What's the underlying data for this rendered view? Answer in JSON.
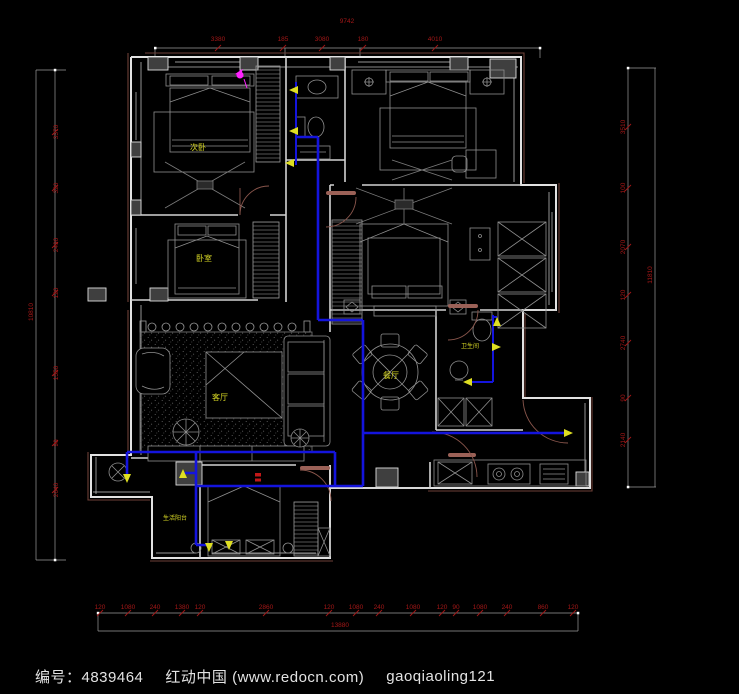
{
  "footer": {
    "id_label": "编号：4839464",
    "site": "红动中国 (www.redocn.com)",
    "author": "gaoqiaoling121"
  },
  "colors": {
    "background": "#000000",
    "wall": "#e2e2e2",
    "outer_line": "#6e4038",
    "furniture": "#8f8f8f",
    "pipe_blue": "#1414dd",
    "outlet_yellow": "#dede22",
    "label_yellow": "#d8d825",
    "dimension_red": "#a31717",
    "accent_magenta": "#ff22ff",
    "symbol_red": "#c01818"
  },
  "plan": {
    "room_labels": [
      {
        "name": "room-label-bedroom-secondary",
        "text": "次卧",
        "x": 198,
        "y": 150,
        "size": 8
      },
      {
        "name": "room-label-bedroom",
        "text": "卧室",
        "x": 204,
        "y": 261,
        "size": 8
      },
      {
        "name": "room-label-living-room",
        "text": "客厅",
        "x": 220,
        "y": 400,
        "size": 8
      },
      {
        "name": "room-label-dining-room",
        "text": "餐厅",
        "x": 391,
        "y": 378,
        "size": 8
      },
      {
        "name": "room-label-bathroom",
        "text": "卫生间",
        "x": 470,
        "y": 348,
        "size": 6
      },
      {
        "name": "room-label-utility-balcony",
        "text": "生活阳台",
        "x": 175,
        "y": 520,
        "size": 6
      }
    ],
    "water_points": [
      {
        "x": 289,
        "y": 90,
        "dir": "left"
      },
      {
        "x": 289,
        "y": 131,
        "dir": "left"
      },
      {
        "x": 285,
        "y": 163,
        "dir": "left"
      },
      {
        "x": 497,
        "y": 317,
        "dir": "up"
      },
      {
        "x": 501,
        "y": 347,
        "dir": "right"
      },
      {
        "x": 463,
        "y": 382,
        "dir": "left"
      },
      {
        "x": 573,
        "y": 433,
        "dir": "right"
      },
      {
        "x": 127,
        "y": 483,
        "dir": "down"
      },
      {
        "x": 183,
        "y": 469,
        "dir": "up"
      },
      {
        "x": 209,
        "y": 552,
        "dir": "down"
      },
      {
        "x": 229,
        "y": 550,
        "dir": "down"
      }
    ],
    "dimensions": {
      "top": {
        "total": "9742",
        "chain": [
          {
            "t": "3380",
            "x": 218
          },
          {
            "t": "185",
            "x": 283
          },
          {
            "t": "3080",
            "x": 322
          },
          {
            "t": "180",
            "x": 363
          },
          {
            "t": "4010",
            "x": 435
          }
        ]
      },
      "left": {
        "total": "10810",
        "chain": [
          {
            "t": "3370",
            "y": 132
          },
          {
            "t": "320",
            "y": 188
          },
          {
            "t": "2490",
            "y": 245
          },
          {
            "t": "120",
            "y": 293
          },
          {
            "t": "1550",
            "y": 373
          },
          {
            "t": "90",
            "y": 443
          },
          {
            "t": "2640",
            "y": 490
          }
        ]
      },
      "right": {
        "total": "11810",
        "chain": [
          {
            "t": "3510",
            "y": 127
          },
          {
            "t": "100",
            "y": 188
          },
          {
            "t": "2070",
            "y": 247
          },
          {
            "t": "120",
            "y": 295
          },
          {
            "t": "2740",
            "y": 343
          },
          {
            "t": "90",
            "y": 398
          },
          {
            "t": "2140",
            "y": 440
          }
        ]
      },
      "bottom": {
        "total": "13880",
        "chain": [
          {
            "t": "120",
            "x": 100
          },
          {
            "t": "1080",
            "x": 128
          },
          {
            "t": "240",
            "x": 155
          },
          {
            "t": "1380",
            "x": 182
          },
          {
            "t": "120",
            "x": 200
          },
          {
            "t": "2860",
            "x": 266
          },
          {
            "t": "120",
            "x": 329
          },
          {
            "t": "1080",
            "x": 356
          },
          {
            "t": "240",
            "x": 379
          },
          {
            "t": "1080",
            "x": 413
          },
          {
            "t": "120",
            "x": 442
          },
          {
            "t": "90",
            "x": 456
          },
          {
            "t": "1080",
            "x": 480
          },
          {
            "t": "240",
            "x": 507
          },
          {
            "t": "860",
            "x": 543
          },
          {
            "t": "120",
            "x": 573
          }
        ]
      }
    }
  }
}
